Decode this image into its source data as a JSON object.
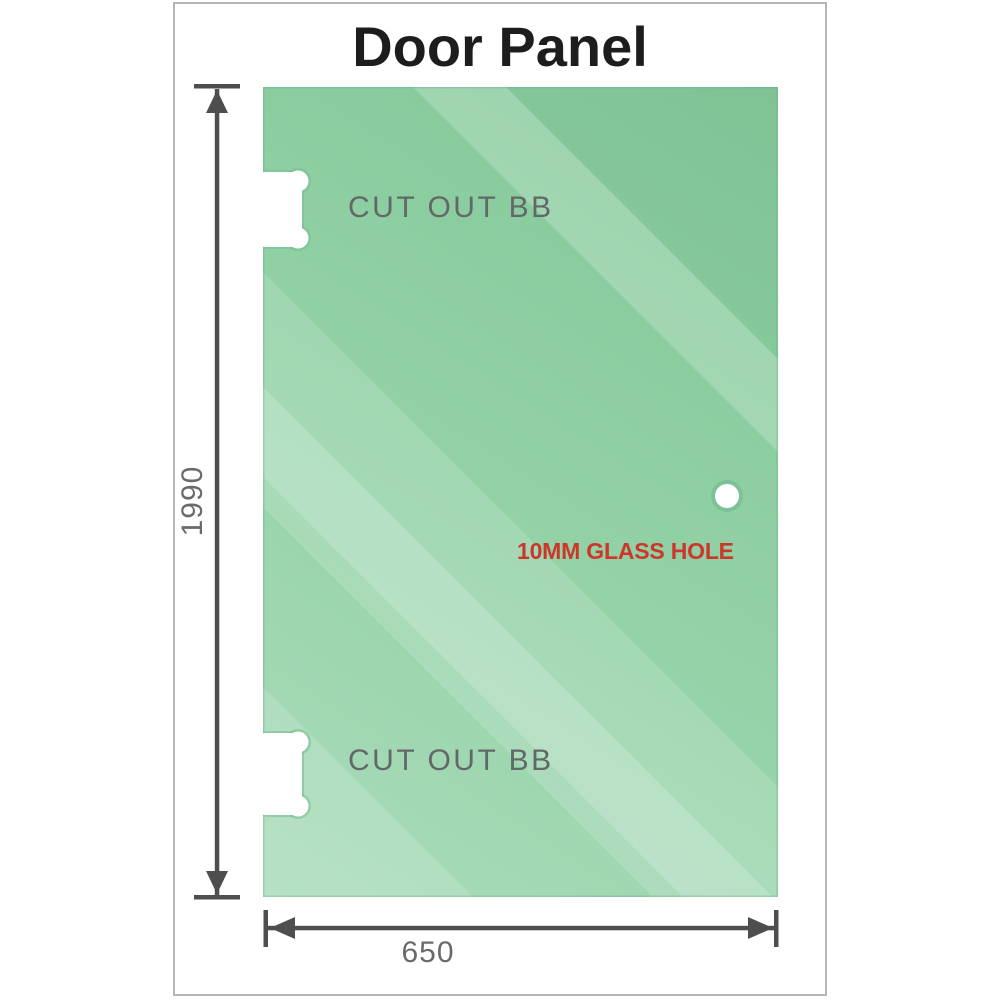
{
  "title": "Door Panel",
  "panel": {
    "cutout_top": {
      "label": "CUT OUT BB"
    },
    "cutout_bottom": {
      "label": "CUT OUT BB"
    },
    "glass_hole": {
      "label": "10MM GLASS HOLE"
    }
  },
  "dimensions": {
    "height": {
      "value": "1990",
      "unit_label": "1990"
    },
    "width": {
      "value": "650",
      "unit_label": "650"
    }
  },
  "colors": {
    "glass_dark": "#83c798",
    "glass_mid": "#92d1a6",
    "glass_light": "#abdcbb",
    "annotation_red": "#cc372a",
    "dimension_line_gray": "#4e4e4e",
    "dimension_text_gray": "#6a6a6a",
    "label_gray": "#616867",
    "title_color": "#1d1d1d",
    "frame_border": "#b6b6b6",
    "cutout_fill": "#ffffff"
  }
}
